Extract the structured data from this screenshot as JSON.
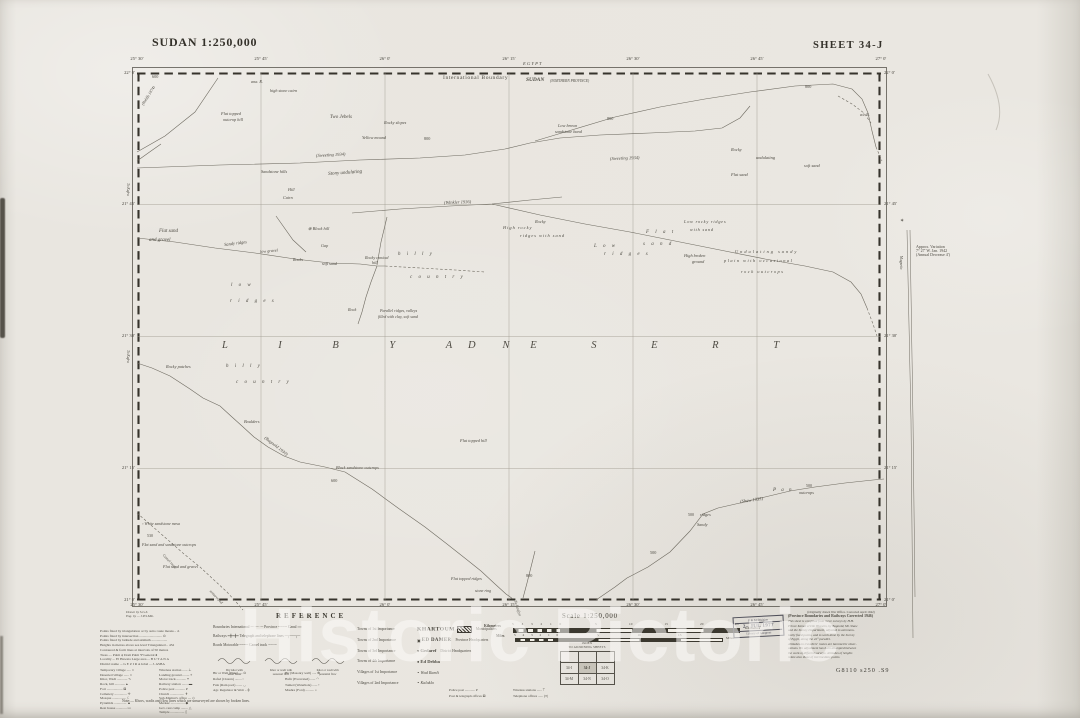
{
  "titles": {
    "left": "SUDAN 1:250,000",
    "right": "SHEET 34-J"
  },
  "watermark": "Historic Pictoric",
  "credits": {
    "c1": "Drawn by S.G.S.",
    "c2": "Eng. by — J.P.S.Mtn."
  },
  "graticule": {
    "lon": [
      "25° 30′",
      "25° 45′",
      "26° 0′",
      "26° 15′",
      "26° 30′",
      "26° 45′",
      "27° 0′"
    ],
    "lat": [
      "22° 0′",
      "21° 45′",
      "21° 30′",
      "21° 15′",
      "21° 0′"
    ]
  },
  "magnetic": {
    "star": "✶",
    "l1": "Approx. Variation",
    "l2": "7° 27′ W. Jan. 1942",
    "l3": "(Annual Decrease 4′)",
    "axis": "Magnetic"
  },
  "routes": [
    {
      "p": "137,152 165,136 195,112 218,78"
    },
    {
      "p": "137,161 151,151 161,144"
    },
    {
      "p": "137,168 220,165 300,163 360,160 420,158 465,155 505,149 530,143 560,138 600,135 650,133 695,131 722,128 740,118 750,106"
    },
    {
      "p": "535,141 575,129 615,117 660,107 705,99 750,92 795,86 833,84 852,89 862,99 868,113 872,131 876,147"
    },
    {
      "p": "876,147 882,161",
      "d": 1
    },
    {
      "p": "838,96 852,104 864,113 871,123",
      "d": 1
    },
    {
      "p": "352,213 400,209 450,206 492,204 530,200 562,197"
    },
    {
      "p": "492,204 540,215 585,224 630,232 675,241 720,250 765,259 805,266 833,272 851,282 861,294 867,308"
    },
    {
      "p": "867,308 873,324 877,336",
      "d": 1
    },
    {
      "p": "276,216 293,240 306,252"
    },
    {
      "p": "387,217 381,242 377,265"
    },
    {
      "p": "137,238 175,242 215,248 255,253 295,259 330,263 360,264 377,266 385,266"
    },
    {
      "p": "377,266 371,282 366,297 362,312 358,324"
    },
    {
      "p": "385,266 420,268 455,270 485,272",
      "d": 1
    },
    {
      "p": "137,363 152,368 170,376 190,389 203,398 220,406 232,417 242,426 254,437 268,447 284,456 300,462 325,467 345,472"
    },
    {
      "p": "345,472 372,489 398,508 425,527 447,544 466,559 481,571 495,584 506,594 513,599"
    },
    {
      "p": "523,598 527,583 531,567 535,551"
    },
    {
      "p": "596,600 615,587 627,578 648,567 670,552 690,531 703,514 718,508 740,503 765,497 790,491 815,487 845,483 873,480 884,479"
    },
    {
      "p": "137,513 152,526 168,540 184,554 200,567 214,580 227,592 237,603 243,610",
      "d": 1
    }
  ],
  "map_labels": [
    {
      "x": 152,
      "y": 75,
      "t": "600",
      "fs": 4.2
    },
    {
      "x": 251,
      "y": 80,
      "t": "ana. R.",
      "it": 1,
      "fs": 4.2
    },
    {
      "x": 270,
      "y": 89,
      "t": "high stone cairn",
      "it": 1,
      "fs": 4.2
    },
    {
      "x": 221,
      "y": 112,
      "t": "Flat topped",
      "it": 1,
      "fs": 4.3
    },
    {
      "x": 223,
      "y": 118,
      "t": "outcrop hill",
      "it": 1,
      "fs": 4.3
    },
    {
      "x": 330,
      "y": 115,
      "t": "Two Jebels",
      "it": 1
    },
    {
      "x": 384,
      "y": 121,
      "t": "Rocky slopes",
      "it": 1,
      "fs": 4.3
    },
    {
      "x": 362,
      "y": 136,
      "t": "Yellow mound",
      "it": 1,
      "fs": 4.3
    },
    {
      "x": 558,
      "y": 124,
      "t": "Low brown",
      "it": 1,
      "fs": 4.3
    },
    {
      "x": 555,
      "y": 130,
      "t": "sandstone band",
      "it": 1,
      "fs": 4.3
    },
    {
      "x": 607,
      "y": 117,
      "t": "800",
      "fs": 4.2
    },
    {
      "x": 424,
      "y": 137,
      "t": "800",
      "fs": 4.2
    },
    {
      "x": 805,
      "y": 85,
      "t": "800",
      "fs": 4.2
    },
    {
      "x": 860,
      "y": 113,
      "t": "a/c R.",
      "it": 1,
      "fs": 4.2
    },
    {
      "x": 316,
      "y": 154,
      "t": "(Sweeting 1934)",
      "it": 1,
      "rot": -3,
      "fs": 4.5
    },
    {
      "x": 610,
      "y": 157,
      "t": "(Sweeting 1934)",
      "it": 1,
      "rot": -2,
      "fs": 4.5
    },
    {
      "x": 328,
      "y": 172,
      "t": "Stony undulating",
      "it": 1,
      "rot": -4
    },
    {
      "x": 261,
      "y": 170,
      "t": "Sandstone hills",
      "it": 1,
      "fs": 4.3
    },
    {
      "x": 288,
      "y": 188,
      "t": "Hill",
      "it": 1,
      "fs": 4.2
    },
    {
      "x": 283,
      "y": 196,
      "t": "Cairn",
      "it": 1,
      "fs": 4.2
    },
    {
      "x": 731,
      "y": 148,
      "t": "Rocky",
      "it": 1,
      "fs": 4.4
    },
    {
      "x": 756,
      "y": 156,
      "t": "undulating",
      "it": 1,
      "fs": 4.4
    },
    {
      "x": 804,
      "y": 164,
      "t": "soft sand",
      "it": 1,
      "fs": 4.4
    },
    {
      "x": 731,
      "y": 173,
      "t": "Flat sand",
      "it": 1,
      "fs": 4.4
    },
    {
      "x": 443,
      "y": 76,
      "t": "International   Boundary",
      "fs": 5.6,
      "ls": 0.6
    },
    {
      "x": 523,
      "y": 62,
      "t": "E G Y P T",
      "it": 1,
      "fs": 4.6
    },
    {
      "x": 526,
      "y": 78,
      "t": "SUDAN",
      "b": 1,
      "it": 1,
      "fs": 5.4
    },
    {
      "x": 550,
      "y": 79.5,
      "t": "(NORTHERN  PROVINCE)",
      "fs": 3.6,
      "it": 1
    },
    {
      "x": 159,
      "y": 229,
      "t": "Flat sand",
      "it": 1
    },
    {
      "x": 149,
      "y": 238,
      "t": "and gravel",
      "it": 1
    },
    {
      "x": 224,
      "y": 243,
      "t": "Sandy ridges",
      "it": 1,
      "rot": -7,
      "fs": 4.4
    },
    {
      "x": 260,
      "y": 250,
      "t": "low gravel",
      "it": 1,
      "rot": -5,
      "fs": 4.2
    },
    {
      "x": 293,
      "y": 258,
      "t": "Rocks",
      "it": 1,
      "fs": 4.2
    },
    {
      "x": 322,
      "y": 262,
      "t": "soft sand",
      "it": 1,
      "fs": 4.2
    },
    {
      "x": 308,
      "y": 227,
      "t": "⊕ Block hill",
      "it": 1,
      "fs": 4.3
    },
    {
      "x": 321,
      "y": 244,
      "t": "Gap",
      "it": 1,
      "fs": 4.2
    },
    {
      "x": 365,
      "y": 256,
      "t": "Rocky conical",
      "it": 1,
      "fs": 4.2
    },
    {
      "x": 372,
      "y": 261,
      "t": "hill",
      "it": 1,
      "fs": 4.2
    },
    {
      "x": 398,
      "y": 252,
      "t": "h i l l y",
      "it": 1,
      "ls": 2.5
    },
    {
      "x": 410,
      "y": 275,
      "t": "c o u n t r y",
      "it": 1,
      "ls": 2.5
    },
    {
      "x": 231,
      "y": 283,
      "t": "l o w",
      "it": 1,
      "ls": 2.5
    },
    {
      "x": 230,
      "y": 299,
      "t": "r i d g e s",
      "it": 1,
      "ls": 2.5
    },
    {
      "x": 348,
      "y": 308,
      "t": "Rock",
      "it": 1,
      "fs": 4.2
    },
    {
      "x": 380,
      "y": 309,
      "t": "Parallel  ridges, valleys",
      "it": 1,
      "fs": 4
    },
    {
      "x": 378,
      "y": 314.5,
      "t": "filled with clay, soft sand",
      "it": 1,
      "fs": 4
    },
    {
      "x": 444,
      "y": 201,
      "t": "(Winkler 1936)",
      "it": 1,
      "rot": -2,
      "fs": 4.5
    },
    {
      "x": 503,
      "y": 226,
      "t": "High rocky",
      "it": 1,
      "fs": 4.4,
      "ls": 1
    },
    {
      "x": 520,
      "y": 234,
      "t": "ridges with sand",
      "it": 1,
      "fs": 4.4,
      "ls": 1
    },
    {
      "x": 535,
      "y": 220,
      "t": "Rocky",
      "it": 1,
      "fs": 4.4
    },
    {
      "x": 646,
      "y": 230,
      "t": "F l a t",
      "it": 1,
      "ls": 2.5
    },
    {
      "x": 643,
      "y": 242,
      "t": "s a n d",
      "it": 1,
      "ls": 2.5
    },
    {
      "x": 594,
      "y": 244,
      "t": "L o w",
      "it": 1,
      "ls": 2.5
    },
    {
      "x": 604,
      "y": 252,
      "t": "r i d g e s",
      "it": 1,
      "ls": 2.5
    },
    {
      "x": 684,
      "y": 220,
      "t": "Low rocky ridges",
      "it": 1,
      "fs": 4.3,
      "ls": 0.8
    },
    {
      "x": 690,
      "y": 228,
      "t": "with sand",
      "it": 1,
      "fs": 4.3,
      "ls": 0.8
    },
    {
      "x": 684,
      "y": 254,
      "t": "High broken",
      "it": 1,
      "fs": 4.3
    },
    {
      "x": 692,
      "y": 260,
      "t": "ground",
      "it": 1,
      "fs": 4.3
    },
    {
      "x": 735,
      "y": 250,
      "t": "Undulating sandy",
      "it": 1,
      "fs": 4.4,
      "ls": 2
    },
    {
      "x": 724,
      "y": 259,
      "t": "plain with occasional",
      "it": 1,
      "fs": 4.4,
      "ls": 1.5
    },
    {
      "x": 741,
      "y": 270,
      "t": "rock outcrops",
      "it": 1,
      "fs": 4.4,
      "ls": 1.5
    },
    {
      "x": 222,
      "y": 341,
      "t": "L I B Y A N",
      "fs": 10.5,
      "ls": 24,
      "it": 1
    },
    {
      "x": 468,
      "y": 341,
      "t": "D E S E R T",
      "fs": 10.5,
      "ls": 26,
      "it": 1
    },
    {
      "x": 166,
      "y": 365,
      "t": "Rocky patches",
      "it": 1,
      "fs": 4.3
    },
    {
      "x": 226,
      "y": 364,
      "t": "h i l l y",
      "it": 1,
      "ls": 2.5
    },
    {
      "x": 236,
      "y": 380,
      "t": "c o u n t r y",
      "it": 1,
      "ls": 2.5
    },
    {
      "x": 244,
      "y": 420,
      "t": "Boulders",
      "it": 1,
      "fs": 4.3
    },
    {
      "x": 266,
      "y": 436,
      "t": "(Bagnold 1930)",
      "it": 1,
      "rot": 38,
      "fs": 4.5
    },
    {
      "x": 336,
      "y": 466,
      "t": "Black sandstone outcrops",
      "it": 1,
      "fs": 4.2
    },
    {
      "x": 331,
      "y": 479,
      "t": "600",
      "fs": 4.2
    },
    {
      "x": 460,
      "y": 439,
      "t": "Flat topped hill",
      "it": 1,
      "fs": 4.3
    },
    {
      "x": 451,
      "y": 577,
      "t": "Flat topped ridges",
      "it": 1,
      "fs": 4.2
    },
    {
      "x": 475,
      "y": 589,
      "t": "stone ring",
      "it": 1,
      "fs": 4
    },
    {
      "x": 526,
      "y": 574,
      "t": "800",
      "fs": 4.2
    },
    {
      "x": 517,
      "y": 600,
      "t": "To Laqiya",
      "it": 1,
      "rot": 72,
      "fs": 4
    },
    {
      "x": 650,
      "y": 551,
      "t": "500",
      "fs": 4.2
    },
    {
      "x": 688,
      "y": 513,
      "t": "500",
      "fs": 4
    },
    {
      "x": 700,
      "y": 513,
      "t": "ridges",
      "it": 1,
      "fs": 4.3
    },
    {
      "x": 697,
      "y": 523,
      "t": "Sandy",
      "it": 1,
      "fs": 4.3
    },
    {
      "x": 740,
      "y": 500,
      "t": "(Shaw 1935)",
      "it": 1,
      "rot": -8,
      "fs": 4.5
    },
    {
      "x": 773,
      "y": 488,
      "t": "P a n",
      "it": 1,
      "ls": 2
    },
    {
      "x": 799,
      "y": 491,
      "t": "outcrops",
      "it": 1,
      "fs": 4.3
    },
    {
      "x": 806,
      "y": 484,
      "t": "500",
      "fs": 4
    },
    {
      "x": 142,
      "y": 522,
      "t": "▫ White sandstone mesa",
      "it": 1,
      "fs": 4
    },
    {
      "x": 147,
      "y": 534,
      "t": "530",
      "fs": 4
    },
    {
      "x": 142,
      "y": 543,
      "t": "Flat sand and sandstone outcrops",
      "it": 1,
      "fs": 4
    },
    {
      "x": 163,
      "y": 565,
      "t": "Flat sand and gravel",
      "it": 1,
      "fs": 4.2
    },
    {
      "x": 164,
      "y": 554,
      "t": "Camel route",
      "it": 1,
      "rot": 47,
      "fs": 3.8
    },
    {
      "x": 211,
      "y": 590,
      "t": "unsurveyed",
      "it": 1,
      "rot": 47,
      "fs": 3.8
    },
    {
      "x": 141,
      "y": 104,
      "t": "(Rohlfs 1874)",
      "it": 1,
      "rot": -58,
      "fs": 4
    },
    {
      "x": 129,
      "y": 183,
      "t": "To Kufra",
      "rot": 90,
      "fs": 3.6,
      "it": 1
    },
    {
      "x": 129,
      "y": 350,
      "t": "To Kufra",
      "rot": 90,
      "fs": 3.6,
      "it": 1
    }
  ],
  "smallprint": {
    "top": [
      "Points fixed by triangulation or by astro route means .. Δ",
      "Points fixed by intersection .......................... ⊙",
      "Points fixed by latitude and azimuth ..................",
      "Heights in metres above sea level   Triangulated .. 452",
      "Contoured & form lines at intervals of 50 metres",
      "Trees .... Palm ψ    Dom Palm Ψ    General ♠",
      "Locality ... El Hawata     Large area ... B U T A N A",
      "District name ... G E Z I R A    Jebel ... J. ASBA"
    ],
    "left": [
      "Temporary village ..... ⌂",
      "Deserted village ...... ⌂",
      "Khor, Wadi ............ ∿",
      "Rock, hill ............ ▴",
      "Fort .................. ⊠",
      "Cemetery .............. ✛",
      "Mosque ................ ☾",
      "Pyramids .............. ▲",
      "Rest house ............ ▭"
    ],
    "right": [
      "Wireless station ...... ⊥",
      "Landing ground ........ ⌖",
      "Motor track ........... ╍",
      "Railway station ....... ▬",
      "Police post ........... P",
      "Church ................ ✝",
      "Sub-Mamur's office .... ◇",
      "Merkaz ................ ◆",
      "Gov. rest camp ........ △",
      "Temple ................ ▯"
    ],
    "note": "Note:— Khors, wadis and flow lines which are unsurveyed are shown by broken lines."
  },
  "reference": {
    "heading": "REFERENCE",
    "lines": [
      "Boundaries    International ─··─··─    Province ╌╌╌╌    Canal ≈≈",
      "Railways ━╋━╋━    Telegraph and telephone lines ─┬──┬─",
      "Roads    Motorable ╌╌╌╌    Camel track ┄┄┄┄"
    ],
    "wadi": [
      {
        "c": [
          "Dry khor with",
          "water holes"
        ]
      },
      {
        "c": [
          "Khor or wadi with",
          "seasonal flow"
        ]
      },
      {
        "c": [
          "Khor or wadi with",
          "perennial flow"
        ]
      }
    ],
    "wells_l": [
      "Bir or Well (Plain) .... ⊙",
      "Rafad (Cistern) ........ ▫",
      "Fula (Rain pool) ....... ◡",
      "Agr. Regulator & Weir .. ╪"
    ],
    "wells_r": [
      "Bir (Masonry well) ..... ⊕",
      "Hafir (Excavated) ...... ◠",
      "Tumed (Waterhole) ...... •",
      "Mashra (Ford) .......... ="
    ],
    "towns": [
      {
        "cls": "Towns of 1st Importance",
        "sym": "",
        "name": "KHARTOUM",
        "desc": "Municipalities",
        "hatch": true
      },
      {
        "cls": "Towns of 2nd Importance",
        "sym": "▣ ",
        "name": "ED DAMER",
        "desc": "Province Headquarters",
        "hatch": false
      },
      {
        "cls": "Towns of 3rd Importance",
        "sym": "● ",
        "name": "Gedaref",
        "desc": "District Headquarters",
        "hatch": false
      },
      {
        "cls": "Towns of 4th Importance",
        "sym": "● ",
        "name": "Ed Debba",
        "desc": "",
        "hatch": false
      },
      {
        "cls": "Villages of 1st Importance",
        "sym": "∘ ",
        "name": "Wad Ramli",
        "desc": "",
        "hatch": false
      },
      {
        "cls": "Villages of 2nd Importance",
        "sym": "∘ ",
        "name": "Kalakla",
        "desc": "",
        "hatch": false
      }
    ],
    "posts_l": [
      "Police post ............ P",
      "Post & telegraph offices ⊠"
    ],
    "posts_r": [
      "Wireless stations ...... ⍑",
      "Telephone offices ...... (T)"
    ]
  },
  "scale": {
    "title": "Scale 1:250,000",
    "km_label": "Kilometres",
    "km_label_right": "Kilometres",
    "mi_label": "Miles",
    "mi_label_right": "Miles",
    "km_marks": [
      [
        "5",
        512
      ],
      [
        "4",
        521.5
      ],
      [
        "3",
        531
      ],
      [
        "2",
        540.5
      ],
      [
        "1",
        550
      ],
      [
        "0",
        559.5
      ],
      [
        "5",
        595
      ],
      [
        "10",
        629
      ],
      [
        "15",
        664.5
      ],
      [
        "20",
        700
      ],
      [
        "25",
        735
      ]
    ],
    "mi_marks": [
      [
        "5",
        514
      ],
      [
        "4",
        522.5
      ],
      [
        "3",
        531
      ],
      [
        "2",
        539.5
      ],
      [
        "1",
        548
      ],
      [
        "0",
        556.5
      ],
      [
        "5",
        597
      ],
      [
        "10",
        637.5
      ],
      [
        "15",
        678
      ]
    ]
  },
  "index": {
    "h1": "INDEX",
    "h2": "TO ADJOINING SHEETS",
    "grid": [
      [
        "",
        "",
        ""
      ],
      [
        "34-I",
        "34-J",
        "34-K"
      ],
      [
        "34-M",
        "34-N",
        "34-O"
      ]
    ],
    "current": "34-J"
  },
  "stamp": {
    "l1": "E & M Division",
    "l2": "2– JUL 1977",
    "l3": "Library of Congress"
  },
  "notes_right": {
    "l0": "(Originally drawn War Office. Corrected April 1942)",
    "h": "(Province Boundaries and Railways Corrected 1946)",
    "body": [
      "This sheet is compiled from recce surveys by H.H.",
      "Prince Kemal el Din Hussein, by Bagnold, Mr. Shaw",
      "and the Survey Department, adjusted to astronom-",
      "ically fixed points, and to work done by the Survey",
      "of Egypt, along the 22° parallel.",
      "Altitudes on travellers' routes are barometric obser-",
      "vations. No adjustment has been attempted between",
      "the work of different surveys. Altitudes of heights",
      "relate also those of intermediate points."
    ],
    "classnum": "G8110 s250 .S9"
  }
}
